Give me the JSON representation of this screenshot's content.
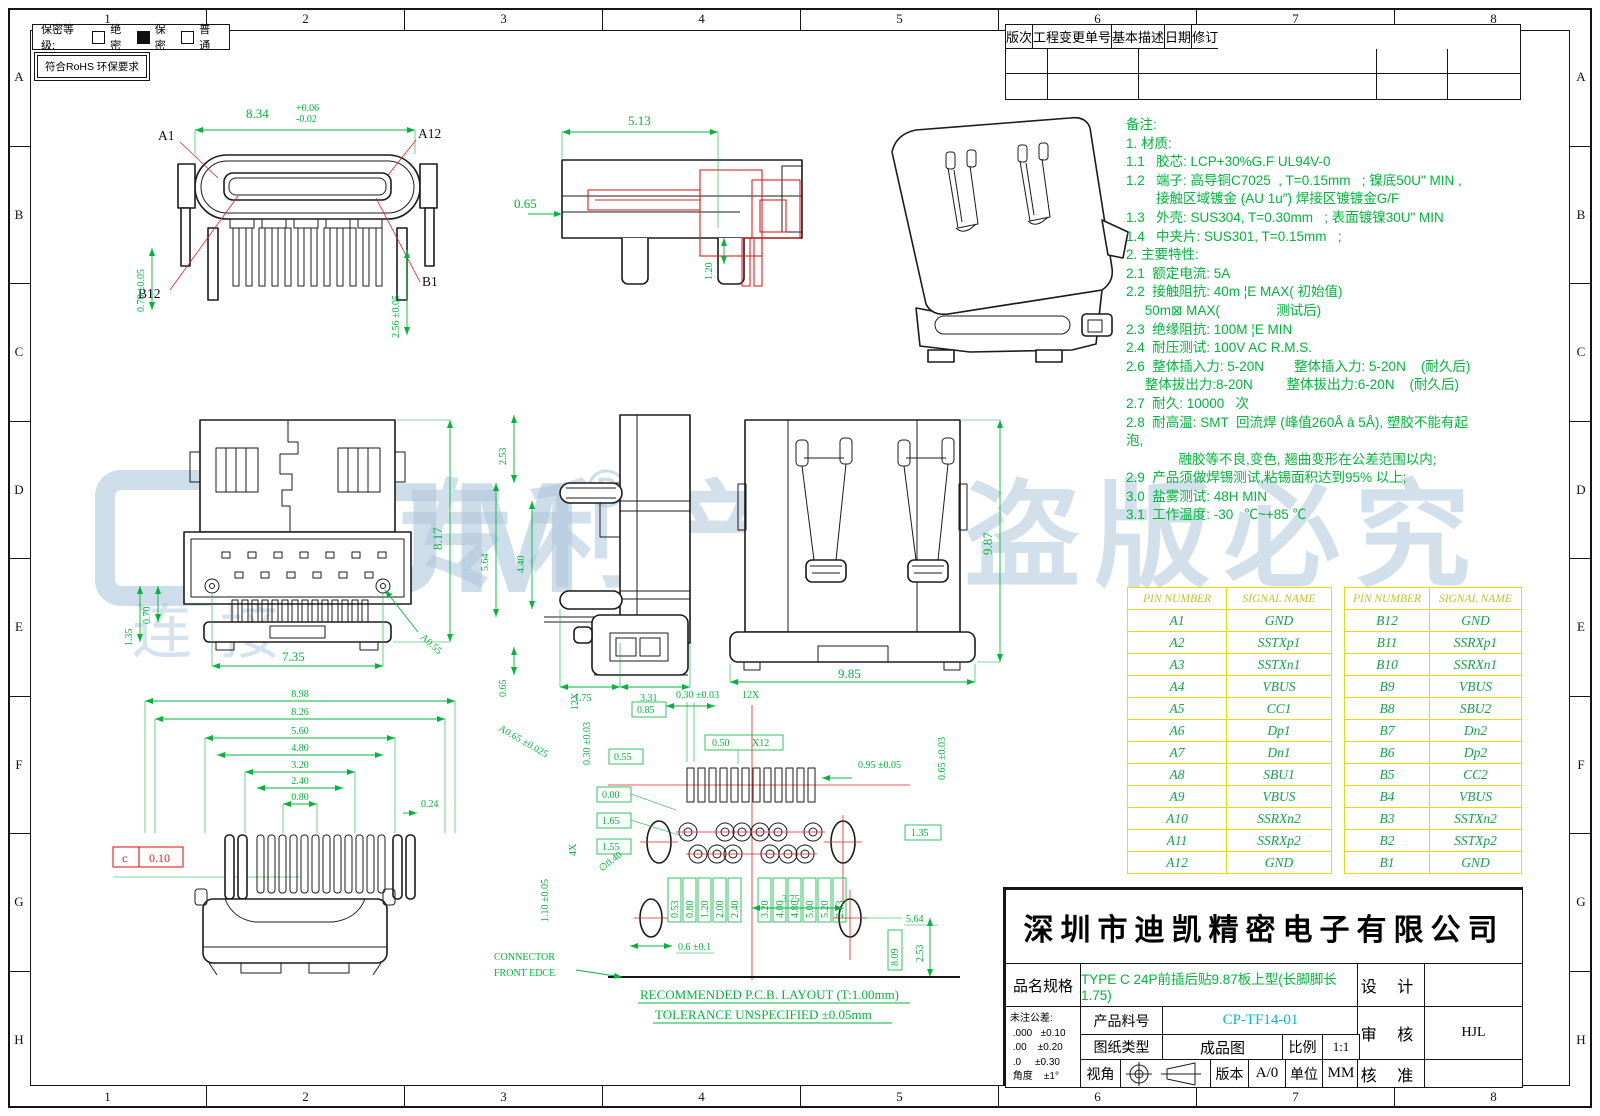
{
  "sheet": {
    "grid_cols": [
      "1",
      "2",
      "3",
      "4",
      "5",
      "6",
      "7",
      "8"
    ],
    "grid_rows": [
      "A",
      "B",
      "C",
      "D",
      "E",
      "F",
      "G",
      "H"
    ]
  },
  "confidential": {
    "label": "保密等级:",
    "options": [
      {
        "label": "绝密",
        "checked": false
      },
      {
        "label": "保密",
        "checked": true
      },
      {
        "label": "普通",
        "checked": false
      }
    ],
    "rohs": "符合RoHS 环保要求"
  },
  "revision_table": {
    "headers": [
      "版次",
      "工程变更单号",
      "基本描述",
      "日期",
      "修订"
    ]
  },
  "notes": {
    "lines": [
      "备注:",
      "1. 材质:",
      "1.1   胶芯: LCP+30%G.F UL94V-0",
      "1.2   端子: 高导铜C7025  , T=0.15mm   ; 镍底50U\" MIN ,",
      "        接触区域镀金 (AU 1u″) 焊接区镀镀金G/F",
      "1.3   外壳: SUS304, T=0.30mm   ; 表面镀镍30U\" MIN",
      "1.4   中夹片: SUS301, T=0.15mm   ;",
      "2. 主要特性:",
      "2.1  额定电流: 5A",
      "2.2  接触阻抗: 40m ¦E MAX( 初始值)",
      "     50m⊠ MAX(               测试后)",
      "2.3  绝缘阻抗: 100M ¦E MIN",
      "2.4  耐压测试: 100V AC R.M.S.",
      "2.6  整体插入力: 5-20N        整体插入力: 5-20N    (耐久后)",
      "     整体拔出力:8-20N         整体拔出力:6-20N    (耐久后)",
      "2.7  耐久: 10000   次",
      "2.8  耐高温: SMT  回流焊 (峰值260Å ā 5Å), 塑胶不能有起",
      "泡,",
      "              融胶等不良,变色, 翘曲变形在公差范围以内;",
      "2.9  产品须做焊锡测试,粘锡面积达到95% 以上;",
      "3.0  盐雾测试: 48H MIN",
      "3.1  工作温度: -30   ℃~+85 ℃"
    ]
  },
  "watermark": {
    "brand": "KJM",
    "reg": "®",
    "sub": "连接",
    "slogan": "专利产品 盗版必究"
  },
  "pin_table": {
    "headers": [
      "PIN NUMBER",
      "SIGNAL NAME"
    ],
    "left": [
      {
        "pin": "A1",
        "name": "GND"
      },
      {
        "pin": "A2",
        "name": "SSTXp1"
      },
      {
        "pin": "A3",
        "name": "SSTXn1"
      },
      {
        "pin": "A4",
        "name": "VBUS"
      },
      {
        "pin": "A5",
        "name": "CC1"
      },
      {
        "pin": "A6",
        "name": "Dp1"
      },
      {
        "pin": "A7",
        "name": "Dn1"
      },
      {
        "pin": "A8",
        "name": "SBU1"
      },
      {
        "pin": "A9",
        "name": "VBUS"
      },
      {
        "pin": "A10",
        "name": "SSRXn2"
      },
      {
        "pin": "A11",
        "name": "SSRXp2"
      },
      {
        "pin": "A12",
        "name": "GND"
      }
    ],
    "right": [
      {
        "pin": "B12",
        "name": "GND"
      },
      {
        "pin": "B11",
        "name": "SSRXp1"
      },
      {
        "pin": "B10",
        "name": "SSRXn1"
      },
      {
        "pin": "B9",
        "name": "VBUS"
      },
      {
        "pin": "B8",
        "name": "SBU2"
      },
      {
        "pin": "B7",
        "name": "Dn2"
      },
      {
        "pin": "B6",
        "name": "Dp2"
      },
      {
        "pin": "B5",
        "name": "CC2"
      },
      {
        "pin": "B4",
        "name": "VBUS"
      },
      {
        "pin": "B3",
        "name": "SSTXn2"
      },
      {
        "pin": "B2",
        "name": "SSTXp2"
      },
      {
        "pin": "B1",
        "name": "GND"
      }
    ]
  },
  "views": {
    "front": {
      "w": "8.34",
      "wp": "+0.06",
      "wm": "-0.02",
      "a1": "A1",
      "a12": "A12",
      "b12": "B12",
      "b1": "B1",
      "h1": "0.70 ±0.05",
      "h2": "2.56 ±0.05"
    },
    "side_top": {
      "d1": "5.13",
      "d2": "0.65",
      "d3": "1.20"
    },
    "top": {
      "d1": "8.17",
      "d2": "7.35",
      "d3": "0.70",
      "d4": "1.35",
      "d5": "A0.55"
    },
    "side_mid": {
      "d1": "2.53",
      "d2": "5.64",
      "d3": "4.40",
      "d4": "0.65",
      "d5": "1.75",
      "d6": "3.31"
    },
    "rear": {
      "d1": "9.87",
      "d2": "9.85"
    },
    "footprint": {
      "s1": "8.98",
      "s2": "8.26",
      "s3": "5.60",
      "s4": "4.80",
      "s5": "3.20",
      "s6": "2.40",
      "s7": "0.80",
      "d_right": "0.24",
      "datum_letter": "c",
      "datum_value": "0.10"
    },
    "pcb": {
      "pad_dim": "0.30 ±0.03",
      "pad_count": "12X",
      "pitch_dim": "0.50",
      "pitch_count": "X12",
      "right_dim": "0.95 ±0.05",
      "right_dim2": "0.65 ±0.03",
      "left_dim": "0.30 ±0.03",
      "left_count": "12X",
      "hole_dim": "∅0.40",
      "hole4": "4X",
      "slot_dim": "1.10 ±0.05",
      "diag_dim": "A0.65 ±0.025",
      "boxed_left": [
        "0.55",
        "0.00",
        "1.65",
        "1.55"
      ],
      "boxed_top": [
        "0.85"
      ],
      "boxed_right": "1.35",
      "boxed_bottom": [
        "0.53",
        "0.80",
        "1.20",
        "2.00",
        "2.40",
        "3.20",
        "4.00",
        "4.80",
        "5.00",
        "5.20",
        "2.73"
      ],
      "boxed_vert": "8.09",
      "center_dim": "3.75",
      "slot_w": "0.6 ±0.1",
      "edge_dim": "5.64",
      "edge_dim2": "2.53",
      "edge_label1": "CONNECTOR",
      "edge_label2": "FRONT EDCE",
      "note1": "RECOMMENDED P.C.B. LAYOUT (T:1.00mm)",
      "note2": "TOLERANCE UNSPECIFIED ±0.05mm"
    }
  },
  "title_block": {
    "company": "深圳市迪凯精密电子有限公司",
    "product_label": "品名规格",
    "product_name": "TYPE C 24P前插后贴9.87板上型(长脚脚长1.75)",
    "design_label": "设 计",
    "design_value": "",
    "tolerance": [
      "未注公差:",
      " .000   ±0.10",
      " .00    ±0.20",
      " .0     ±0.30",
      " 角度    ±1°"
    ],
    "part_label": "产品料号",
    "part_no": "CP-TF14-01",
    "audit_label": "审 核",
    "audit_value": "HJL",
    "type_label": "图纸类型",
    "type_value": "成品图",
    "scale_label": "比例",
    "scale_value": "1:1",
    "approve_label": "核 准",
    "approve_value": "",
    "view_label": "视角",
    "version_label": "版本",
    "version_value": "A/0",
    "unit_label": "单位",
    "unit_value": "MM"
  }
}
